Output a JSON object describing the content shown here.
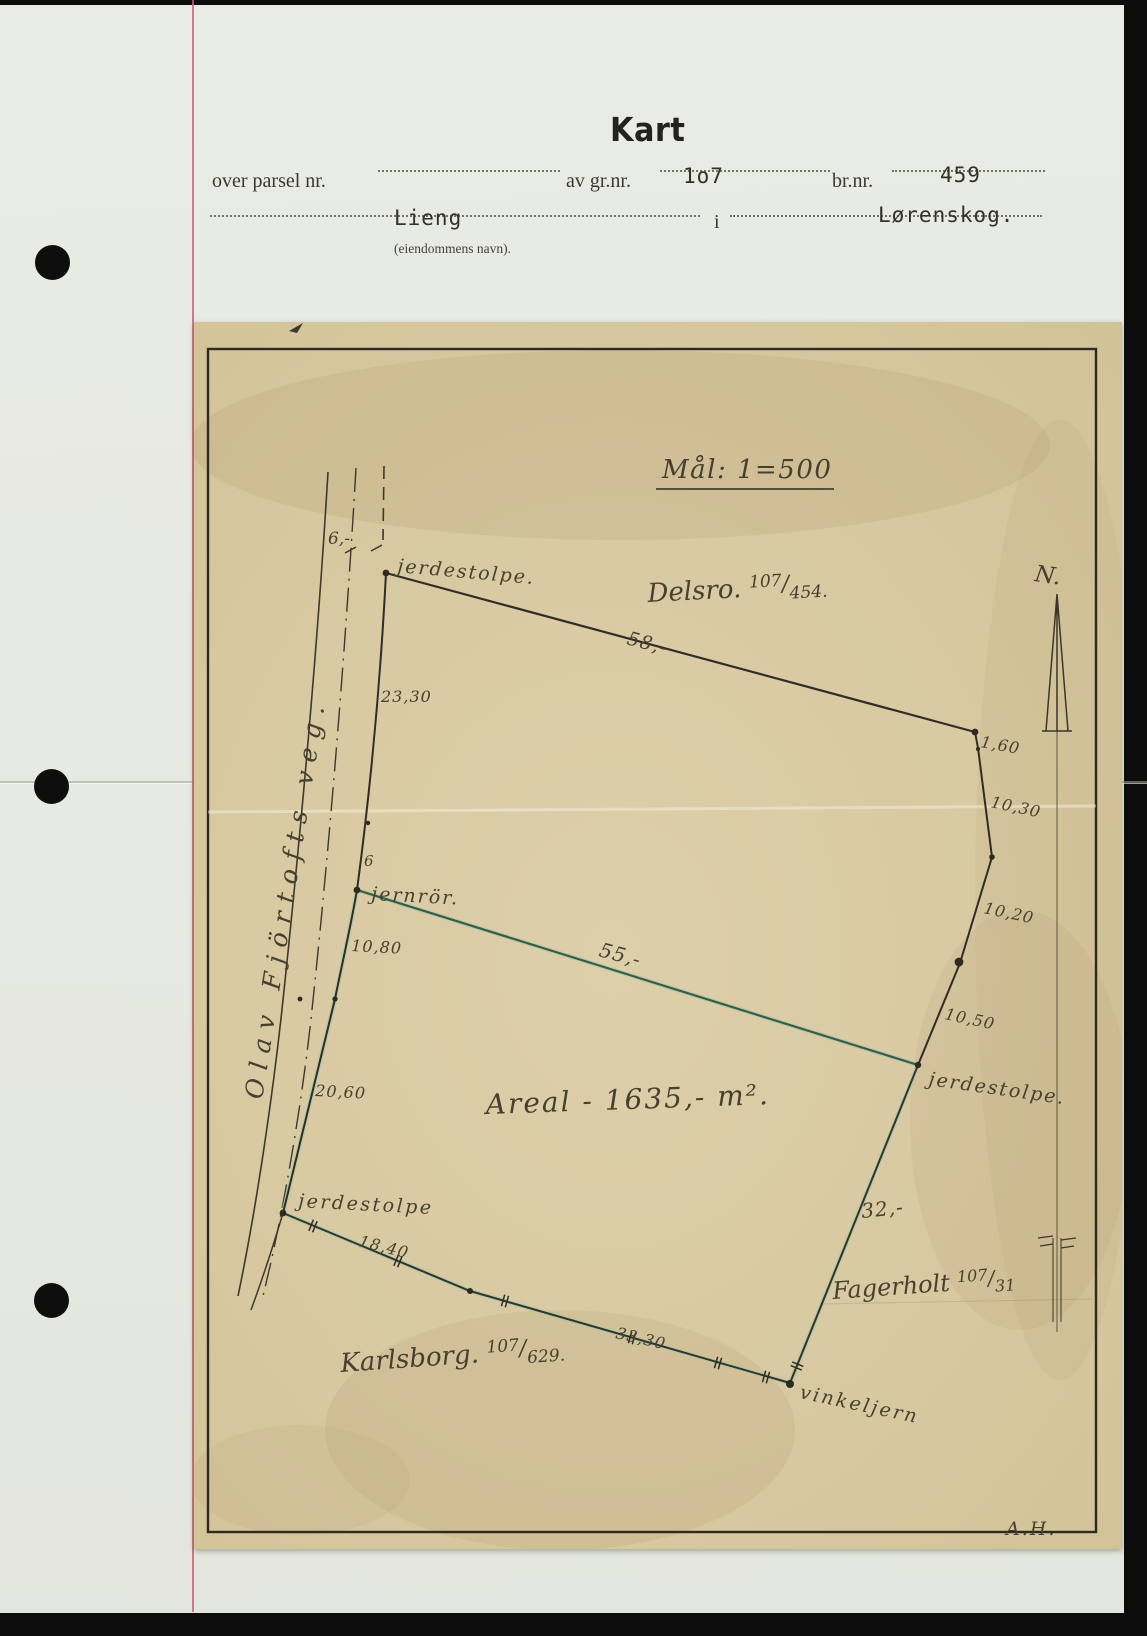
{
  "form": {
    "title": "Kart",
    "line1": {
      "label_parsel": "over parsel nr.",
      "label_gnr": "av gr.nr.",
      "gnr_value": "1o7",
      "label_bnr": "br.nr.",
      "bnr_value": "459"
    },
    "line2": {
      "property_name": "Lieng",
      "label_i": "i",
      "municipality": "Lørenskog.",
      "caption": "(eiendommens navn)."
    }
  },
  "map": {
    "scale_label": "Mål: 1=500",
    "north_label": "N.",
    "road_name": "Olav Fjörtofts veg.",
    "area_label": "Areal - 1635,- m².",
    "surveyor_initials": "A.H.",
    "neighbors": {
      "delsro": {
        "name": "Delsro. ",
        "num": "107",
        "slash": "/",
        "den": "454."
      },
      "karlsborg": {
        "name": "Karlsborg. ",
        "num": "107",
        "slash": "/",
        "den": "629."
      },
      "fagerholt": {
        "name": "Fagerholt ",
        "num": "107",
        "slash": "/",
        "den": "31"
      }
    },
    "markers": {
      "jerdestolpe_top": "jerdestolpe.",
      "jernror": "jernrör.",
      "jerdestolpe_east": "jerdestolpe.",
      "jerdestolpe_sw": "jerdestolpe",
      "vinkeljern": "vinkeljern"
    },
    "measurements": {
      "road_width": "6,-",
      "road_width_mid": "6",
      "north_side": "58,-",
      "east_1": "1,60",
      "east_2": "10,30",
      "east_3": "10,20",
      "east_4": "10,50",
      "west_upper": "23,30",
      "west_1": "10,80",
      "west_2": "20,60",
      "mid_line": "55,-",
      "south_1": "18,40",
      "south_2": "33,30",
      "east_side": "32,-"
    },
    "colors": {
      "parcel_line_green": "#3a5c45",
      "parcel_glow_green": "#9ccaa8",
      "map_paper": "#d8c9a1",
      "form_paper": "#e7eae2",
      "red_margin": "#c75f6a",
      "ink": "#2f2d26"
    }
  }
}
